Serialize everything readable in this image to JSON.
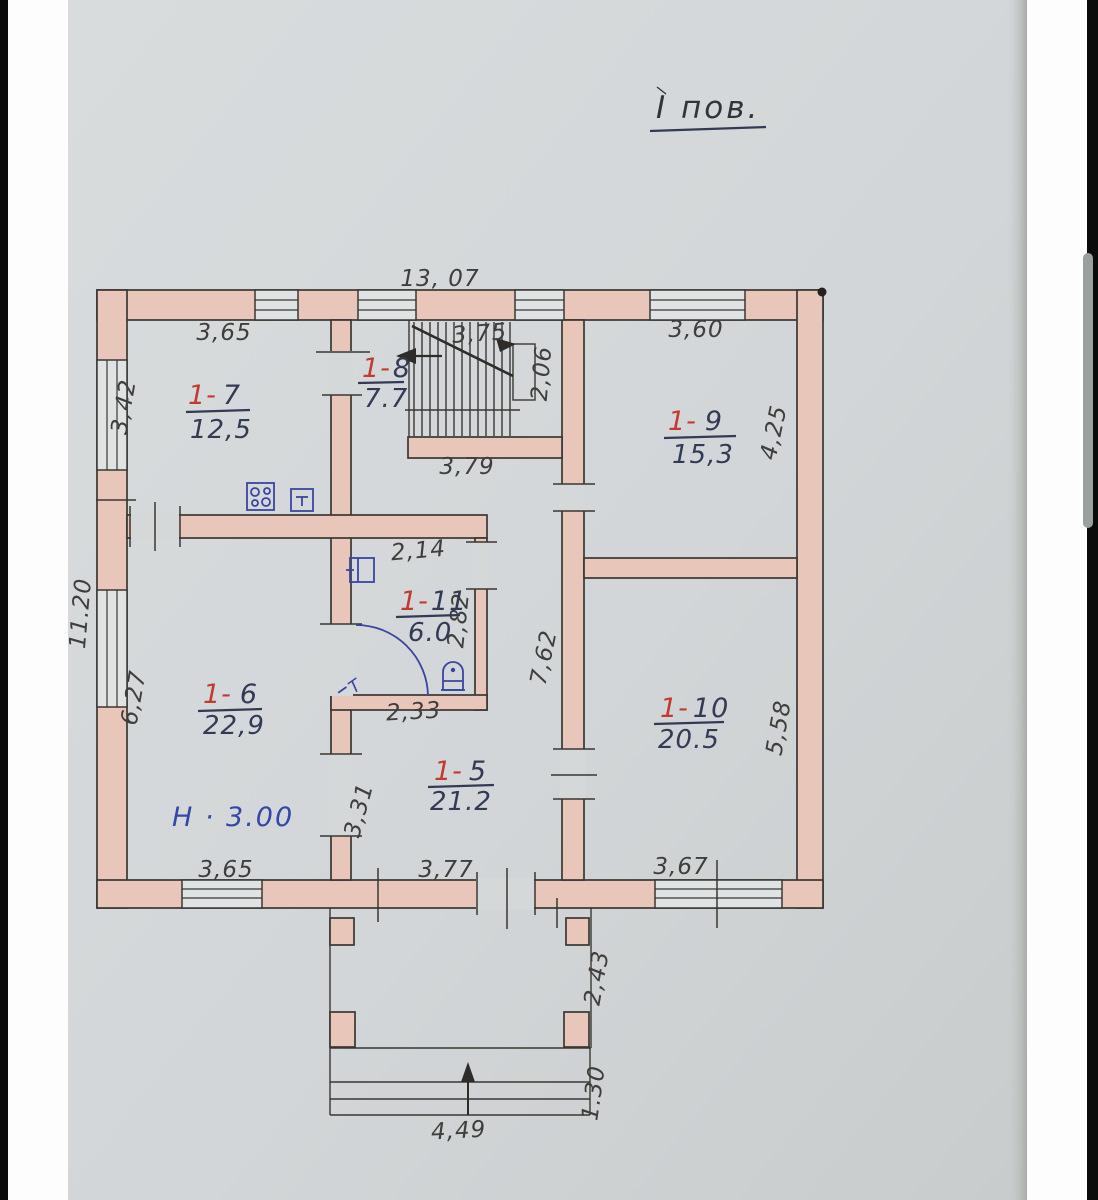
{
  "title": {
    "text": "І пов."
  },
  "rooms": {
    "r7": {
      "prefix": "1-",
      "num": "7",
      "area": "12,5"
    },
    "r8": {
      "prefix": "1-",
      "num": "8",
      "area": "7.7"
    },
    "r9": {
      "prefix": "1-",
      "num": "9",
      "area": "15,3"
    },
    "r11": {
      "prefix": "1-",
      "num": "11",
      "area": "6.0"
    },
    "r6": {
      "prefix": "1-",
      "num": "6",
      "area": "22,9"
    },
    "r5": {
      "prefix": "1-",
      "num": "5",
      "area": "21.2"
    },
    "r10": {
      "prefix": "1-",
      "num": "10",
      "area": "20.5"
    }
  },
  "dims": {
    "top_overall": "13, 07",
    "r7_top": "3,65",
    "stairs_top": "3,75",
    "r9_top": "3,60",
    "left_upper": "3,42",
    "stairs_side": "2,06",
    "r9_right": "4,25",
    "hall_top": "3,79",
    "bath_top": "2,14",
    "bath_right": "2,82",
    "left_overall": "11.20",
    "left_lower": "6,27",
    "corridor": "7,62",
    "r10_right": "5,58",
    "bath_bottom": "2,33",
    "partition": "3,31",
    "bottom_left": "3,65",
    "bottom_mid": "3,77",
    "bottom_right": "3,67",
    "porch_side": "2,43",
    "porch_steps": "1.30",
    "porch_bottom": "4,49"
  },
  "notes": {
    "height": "Н · 3.00",
    "door_mark": "Т"
  },
  "colors": {
    "wall": "#e8c6ba",
    "red": "#c23b30",
    "ink": "#323a54",
    "pencil": "#3f3e3c",
    "blue": "#3946a0",
    "note": "#3347a8"
  }
}
